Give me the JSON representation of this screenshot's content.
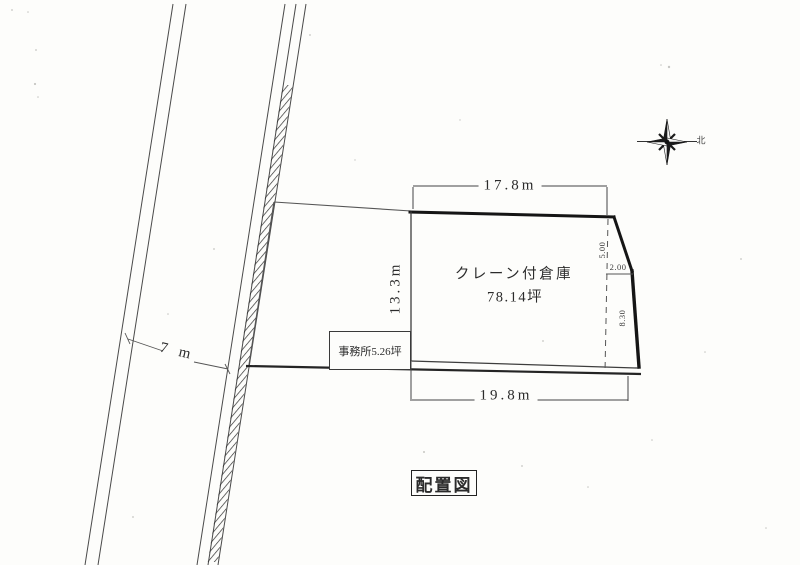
{
  "page": {
    "background": "#fdfdfb",
    "ink": "#2b2b2b"
  },
  "plan": {
    "title": "配置図",
    "north_label": "北",
    "road": {
      "width_label": "7 m"
    },
    "parcel": {
      "top_dim": "17.8m",
      "left_dim": "13.3m",
      "bottom_dim": "19.8m",
      "corner_dims": {
        "upper": "5.00",
        "middle": "2.00",
        "lower": "8.30"
      }
    },
    "warehouse": {
      "name": "クレーン付倉庫",
      "area": "78.14坪"
    },
    "office": {
      "label": "事務所5.26坪"
    }
  }
}
